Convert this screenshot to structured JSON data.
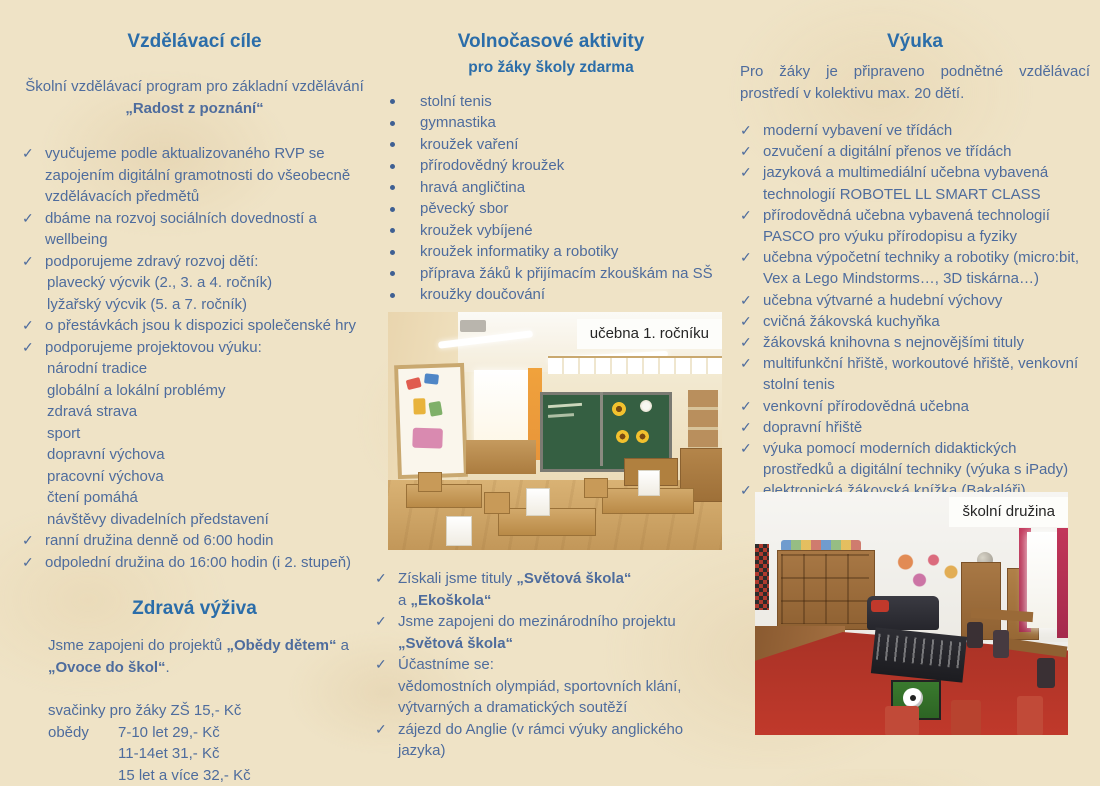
{
  "colors": {
    "background": "#efe3c6",
    "heading": "#2b6da9",
    "body_text": "#4e6c9d",
    "photo_label_bg": "#fdfdfa",
    "photo_label_text": "#262626"
  },
  "icons": {
    "check": "✓",
    "bullet": "●"
  },
  "left_column": {
    "title": "Vzdělávací cíle",
    "intro_line1": "Školní vzdělávací program pro základní vzdělávání",
    "intro_line2": "„Radost z poznání“",
    "goals": [
      {
        "text": "vyučujeme podle aktualizovaného RVP se zapojením digitální gramotnosti do všeobecně vzdělávacích předmětů"
      },
      {
        "text": "dbáme na rozvoj sociálních dovedností a wellbeing"
      },
      {
        "text": "podporujeme zdravý rozvoj dětí:",
        "subitems": [
          "plavecký výcvik (2., 3. a 4. ročník)",
          "lyžařský výcvik (5. a 7. ročník)"
        ]
      },
      {
        "text": "o přestávkách jsou k dispozici společenské hry"
      },
      {
        "text": "podporujeme projektovou výuku:",
        "subitems": [
          "národní tradice",
          "globální a lokální problémy",
          "zdravá strava",
          "sport",
          "dopravní výchova",
          "pracovní výchova",
          "čtení pomáhá",
          "návštěvy divadelních představení"
        ]
      },
      {
        "text": "ranní družina denně od 6:00 hodin"
      },
      {
        "text": "odpolední družina do 16:00 hodin (i 2. stupeň)"
      }
    ],
    "nutrition": {
      "title": "Zdravá výživa",
      "intro_normal1": "Jsme zapojeni do projektů ",
      "intro_bold1": "„Obědy dětem“",
      "intro_normal2": " a ",
      "intro_bold2": "„Ovoce do škol“",
      "intro_normal3": ".",
      "snack_line": "svačinky pro žáky ZŠ 15,- Kč",
      "lunch_label": "obědy",
      "lunch_lines": [
        "7-10 let 29,- Kč",
        "11-14et 31,- Kč",
        "15 let a více 32,- Kč"
      ]
    }
  },
  "middle_column": {
    "title": "Volnočasové aktivity",
    "subtitle": "pro žáky školy zdarma",
    "activities": [
      "stolní tenis",
      "gymnastika",
      "kroužek vaření",
      "přírodovědný kroužek",
      "hravá angličtina",
      "pěvecký sbor",
      "kroužek vybíjené",
      "kroužek informatiky a robotiky",
      "příprava žáků k přijímacím zkouškám na SŠ",
      "kroužky doučování"
    ],
    "photo_label": "učebna 1. ročníku",
    "achievements": {
      "a1_normal1": "Získali jsme tituly ",
      "a1_bold1": "„Světová škola“",
      "a1_line2_normal": "a ",
      "a1_line2_bold": "„Ekoškola“",
      "a2_line1": "Jsme zapojeni do mezinárodního projektu",
      "a2_line2_bold": "„Světová škola“",
      "a3_line1": "Účastníme se:",
      "a3_line2": "vědomostních olympiád, sportovních klání,",
      "a3_line3": "výtvarných a dramatických soutěží",
      "a4_line1": "zájezd do Anglie (v rámci výuky anglického",
      "a4_line2": "jazyka)"
    }
  },
  "right_column": {
    "title": "Výuka",
    "intro": "Pro žáky je připraveno podnětné vzdělávací prostředí v kolektivu max. 20 dětí.",
    "features": [
      "moderní vybavení ve třídách",
      "ozvučení a digitální přenos ve třídách",
      "jazyková a multimediální učebna vybavená technologií ROBOTEL LL SMART CLASS",
      "přírodovědná učebna vybavená technologií PASCO pro výuku přírodopisu a fyziky",
      "učebna výpočetní techniky a robotiky (micro:bit, Vex a Lego Mindstorms…, 3D tiskárna…)",
      "učebna výtvarné a hudební výchovy",
      "cvičná žákovská kuchyňka",
      "žákovská knihovna s nejnovějšími tituly",
      "multifunkční hřiště, workoutové hřiště, venkovní stolní tenis",
      "venkovní přírodovědná učebna",
      "dopravní hřiště",
      "výuka pomocí moderních didaktických prostředků a digitální techniky (výuka s iPady)",
      "elektronická žákovská knížka (Bakaláři)"
    ],
    "photo_label": "školní družina"
  }
}
